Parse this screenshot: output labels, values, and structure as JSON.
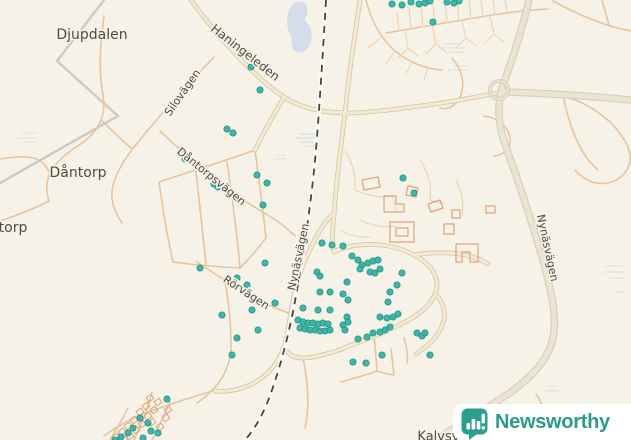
{
  "logo": {
    "name": "Newsworthy"
  },
  "map": {
    "bg": "#f7f2e8",
    "dot_color": "#38b2a2",
    "layers": [
      {
        "type": "line",
        "name": "boundary-path",
        "d": "M104,0 L57,61 L118,116 L0,183",
        "stroke": "#cbcbc4",
        "w": 2.5
      },
      {
        "type": "shape",
        "name": "water-area",
        "d": "M291,6 C294,1 301,0 306,4 C309,9 307,15 305,20 C310,25 313,33 311,41 C309,49 303,54 296,52 C291,50 292,42 291,36 C287,30 286,20 288,13 C289,9 290,8 291,6 Z",
        "fill": "#d4deea"
      },
      {
        "type": "marsh",
        "name": "marsh-texture",
        "groups": [
          {
            "color": "#d9e2ee",
            "lines": [
              [
                300,
                134,
                14
              ],
              [
                296,
                138,
                20
              ],
              [
                302,
                142,
                16
              ],
              [
                306,
                146,
                10
              ]
            ]
          },
          {
            "color": "#e4e4de",
            "lines": [
              [
                445,
                44,
                16
              ],
              [
                440,
                48,
                24
              ],
              [
                450,
                52,
                14
              ],
              [
                455,
                66,
                12
              ],
              [
                448,
                70,
                18
              ]
            ]
          },
          {
            "color": "#e4e4de",
            "lines": [
              [
                608,
                266,
                14
              ],
              [
                604,
                272,
                20
              ],
              [
                610,
                278,
                14
              ],
              [
                615,
                292,
                10
              ]
            ]
          },
          {
            "color": "#e4e4de",
            "lines": [
              [
                548,
                386,
                10
              ],
              [
                545,
                391,
                14
              ]
            ]
          },
          {
            "color": "#e6e6e0",
            "lines": [
              [
                22,
                133,
                14
              ],
              [
                18,
                138,
                18
              ],
              [
                25,
                142,
                10
              ]
            ]
          },
          {
            "color": "#e6e6e0",
            "lines": [
              [
                276,
                155,
                10
              ],
              [
                273,
                159,
                12
              ]
            ]
          }
        ]
      },
      {
        "type": "roads",
        "name": "minor-road",
        "stroke": "#e7c49e",
        "w": 1.6,
        "paths": [
          "M104,16 C100,45 99,70 102,88 C104,102 105,110 101,120 C96,133 86,141 76,147 C64,155 55,163 50,173 C46,182 46,192 49,201",
          "M49,201 C36,208 20,214 6,219 L0,221",
          "M0,159 C12,157 24,156 33,158 C42,160 46,166 50,173",
          "M101,120 C112,131 121,139 131,148",
          "M214,57 C188,84 158,117 135,146 C122,162 114,177 112,191 C111,204 116,214 122,223",
          "M160,131 C178,148 198,166 218,182 C236,196 256,208 274,219 C282,224 289,230 295,236",
          "M255,150 C222,162 189,172 159,182",
          "M159,182 C163,210 167,236 173,262",
          "M173,262 C196,265 219,267 240,268",
          "M255,150 C259,180 263,210 266,238",
          "M266,238 C257,250 248,260 240,268",
          "M196,171 L206,264",
          "M227,162 C232,196 237,232 240,268",
          "M197,262 C224,280 252,298 276,308 L293,315",
          "M225,281 C229,304 231,327 231,346 C231,360 226,374 217,385 C211,392 204,398 197,403",
          "M216,390 C196,396 176,402 160,408 C140,414 120,424 104,436",
          "M152,392 C148,408 142,424 134,440",
          "M170,402 C164,416 158,428 152,440",
          "M128,408 C122,420 116,430 110,440",
          "M374,334 L377,371 C366,375 352,379 341,382",
          "M391,349 L394,375 C388,374 382,373 377,371",
          "M404,338 C407,348 408,356 407,363",
          "M303,358 C308,382 310,406 305,428",
          "M563,96 C592,104 616,122 628,147 C633,160 629,172 618,179 C603,188 586,183 575,170",
          "M563,96 C570,128 580,155 598,170",
          "M553,1 C571,11 591,20 613,27 L631,31",
          "M602,0 L609,25",
          "M536,394 C543,404 546,414 544,424",
          "M386,33 C420,27 456,21 492,15 C512,12 530,10 548,9",
          "M366,0 C372,24 384,44 402,56 C414,64 428,69 442,70",
          "M452,58 C462,70 466,84 460,97 C456,106 448,110 440,108",
          "M484,116 C498,118 508,126 510,138 C511,148 504,155 494,156"
        ]
      },
      {
        "type": "roads",
        "name": "driveway",
        "stroke": "#eed7b8",
        "w": 1.3,
        "paths": [
          "M399,31 L397,12 M411,29 L409,8 M423,27 L421,6 M435,25 L433,4 M447,23 L445,2 M459,21 L457,0 M471,19 L469,0 M483,17 L481,0 M495,15 L493,0 M507,13 L505,0",
          "M405,31 L408,48 M408,48 L398,58 M408,48 L418,56 M432,25 L436,44 M436,44 L426,54 M436,44 L446,52 M462,21 L466,38 M466,38 L456,48 M466,38 L476,46 M490,16 L494,34 M494,34 L484,44 M494,34 L504,42",
          "M380,38 L368,48 M394,52 L386,64 M412,62 L406,74 M428,68 L424,80",
          "M345,150 C352,162 356,176 355,190 M355,190 C368,196 380,198 392,196 M392,196 L396,210",
          "M360,220 C372,226 384,228 396,226 M340,230 C350,236 360,238 370,237",
          "M420,160 C428,172 432,186 430,200 M430,200 L444,204",
          "M456,180 C462,192 464,204 462,216"
        ]
      },
      {
        "type": "roads2",
        "name": "secondary-road",
        "casing": "#d9c8a6",
        "cw": 4.8,
        "fill": "#f3ead6",
        "fw": 3.0,
        "paths": [
          "M191,0 C214,32 252,76 284,97 C306,111 330,113 352,113 C376,112 398,109 420,106 C448,103 476,97 503,92",
          "M284,97 C273,116 263,133 255,150",
          "M360,0 C355,35 350,65 347,95 C342,140 336,180 334,215 C332,233 332,243 334,252",
          "M334,252 C356,241 391,242 414,255 C433,265 441,280 435,294 C428,311 408,321 393,328 C372,338 353,344 342,349 C328,354 314,358 302,358 C295,358 291,356 288,352",
          "M333,214 C324,222 314,240 306,258 C298,276 293,298 290,318 C288,334 285,348 278,360 C270,373 258,382 245,387 C234,391 224,392 215,391",
          "M435,294 C444,302 447,314 442,326 C438,336 428,346 416,354",
          "M414,255 C432,252 450,252 466,255 C474,257 482,260 488,264"
        ]
      },
      {
        "type": "roads2",
        "name": "highway",
        "casing": "#d7ceba",
        "cw": 7.5,
        "fill": "#ebe4d2",
        "fw": 5.2,
        "paths": [
          "M529,0 C521,34 510,66 502,88 C497,106 498,126 506,147 C518,180 532,222 544,264 C552,294 557,317 553,338 C548,362 526,383 499,400 C474,416 452,429 436,440",
          "M502,92 C544,93 588,96 631,100"
        ]
      },
      {
        "type": "circle",
        "name": "interchange-loop",
        "cx": 499,
        "cy": 90,
        "r": 9,
        "casing": "#d7ceba",
        "cw": 4,
        "fill": "#ebe4d2",
        "fw": 2
      },
      {
        "type": "rail",
        "name": "railway",
        "d": "M326,0 C323,50 320,100 316,150 C312,195 305,245 297,290 C291,325 283,358 272,390 C264,414 254,430 245,440",
        "base": "#fbfaf6",
        "bw": 4.5,
        "dash": "#45453f",
        "dw": 1.8,
        "dashes": "7 6"
      },
      {
        "type": "roads",
        "name": "building-outline",
        "stroke": "#dfa07b",
        "w": 1.2,
        "paths": [
          "M362,180 l16,-3 l2,10 l-16,3 Z",
          "M384,196 l12,0 l0,8 l8,0 l0,8 l-20,0 Z",
          "M408,186 l10,2 l-2,9 l-10,-2 Z",
          "M390,222 l24,0 l0,20 l-24,0 Z M396,228 l12,0 l0,8 l-12,0 Z",
          "M428,204 l12,-4 l3,8 l-12,4 Z",
          "M444,224 l10,0 l0,10 l-10,0 Z",
          "M456,244 l22,0 l0,18 l-8,0 l0,-10 l-8,0 l0,10 l-6,0 Z",
          "M486,206 l9,0 l0,7 l-9,0 Z",
          "M452,210 l8,0 l0,8 l-8,0 Z"
        ]
      },
      {
        "type": "rects",
        "name": "allotment-hut",
        "stroke": "#dfa07b",
        "w": 1,
        "rw": 6,
        "rh": 5,
        "rot": -35,
        "pts": [
          [
            150,
            398
          ],
          [
            158,
            402
          ],
          [
            146,
            406
          ],
          [
            154,
            410
          ],
          [
            140,
            412
          ],
          [
            148,
            416
          ],
          [
            134,
            420
          ],
          [
            142,
            424
          ],
          [
            128,
            426
          ],
          [
            136,
            430
          ],
          [
            122,
            432
          ],
          [
            130,
            436
          ],
          [
            116,
            437
          ],
          [
            124,
            440
          ],
          [
            152,
            422
          ],
          [
            160,
            427
          ],
          [
            166,
            418
          ],
          [
            168,
            410
          ]
        ]
      },
      {
        "type": "dots",
        "name": "poi-dot",
        "fill": "#38b2a2",
        "stroke": "#1f9488",
        "r": 3.1,
        "pts": [
          [
            392,
            4
          ],
          [
            402,
            5
          ],
          [
            411,
            2
          ],
          [
            419,
            4
          ],
          [
            425,
            3
          ],
          [
            430,
            1
          ],
          [
            447,
            2
          ],
          [
            454,
            3
          ],
          [
            459,
            1
          ],
          [
            433,
            22
          ],
          [
            251,
            67
          ],
          [
            260,
            90
          ],
          [
            227,
            129
          ],
          [
            233,
            133
          ],
          [
            185,
            159
          ],
          [
            257,
            175
          ],
          [
            267,
            183
          ],
          [
            214,
            184
          ],
          [
            218,
            187
          ],
          [
            263,
            205
          ],
          [
            403,
            178
          ],
          [
            414,
            193
          ],
          [
            200,
            268
          ],
          [
            265,
            263
          ],
          [
            237,
            278
          ],
          [
            247,
            285
          ],
          [
            275,
            303
          ],
          [
            252,
            310
          ],
          [
            222,
            315
          ],
          [
            258,
            330
          ],
          [
            237,
            338
          ],
          [
            232,
            355
          ],
          [
            322,
            243
          ],
          [
            332,
            245
          ],
          [
            343,
            246
          ],
          [
            352,
            256
          ],
          [
            358,
            260
          ],
          [
            362,
            265
          ],
          [
            368,
            263
          ],
          [
            373,
            261
          ],
          [
            378,
            260
          ],
          [
            360,
            269
          ],
          [
            370,
            272
          ],
          [
            375,
            273
          ],
          [
            380,
            269
          ],
          [
            317,
            272
          ],
          [
            320,
            276
          ],
          [
            402,
            273
          ],
          [
            397,
            285
          ],
          [
            347,
            282
          ],
          [
            320,
            292
          ],
          [
            330,
            292
          ],
          [
            343,
            294
          ],
          [
            390,
            292
          ],
          [
            388,
            302
          ],
          [
            348,
            300
          ],
          [
            303,
            308
          ],
          [
            318,
            310
          ],
          [
            330,
            310
          ],
          [
            347,
            317
          ],
          [
            348,
            322
          ],
          [
            380,
            317
          ],
          [
            387,
            318
          ],
          [
            393,
            317
          ],
          [
            398,
            314
          ],
          [
            298,
            320
          ],
          [
            303,
            322
          ],
          [
            308,
            323
          ],
          [
            313,
            323
          ],
          [
            318,
            324
          ],
          [
            323,
            323
          ],
          [
            328,
            324
          ],
          [
            300,
            328
          ],
          [
            305,
            329
          ],
          [
            310,
            330
          ],
          [
            315,
            330
          ],
          [
            320,
            331
          ],
          [
            325,
            331
          ],
          [
            330,
            330
          ],
          [
            343,
            325
          ],
          [
            345,
            330
          ],
          [
            385,
            330
          ],
          [
            390,
            327
          ],
          [
            367,
            337
          ],
          [
            358,
            339
          ],
          [
            373,
            333
          ],
          [
            380,
            332
          ],
          [
            417,
            333
          ],
          [
            422,
            336
          ],
          [
            425,
            333
          ],
          [
            430,
            355
          ],
          [
            382,
            355
          ],
          [
            353,
            362
          ],
          [
            366,
            363
          ],
          [
            167,
            399
          ],
          [
            140,
            418
          ],
          [
            148,
            423
          ],
          [
            133,
            428
          ],
          [
            151,
            431
          ],
          [
            158,
            433
          ],
          [
            143,
            438
          ],
          [
            121,
            437
          ],
          [
            115,
            440
          ],
          [
            128,
            433
          ]
        ]
      },
      {
        "type": "labels",
        "name": "place-label",
        "color": "#4c4c43",
        "halo": "#f7f2e8",
        "items": [
          {
            "t": "Djupdalen",
            "x": 92,
            "y": 35,
            "s": 14,
            "r": 0
          },
          {
            "t": "Dåntorp",
            "x": 78,
            "y": 173,
            "s": 14,
            "r": 0
          },
          {
            "t": "torp",
            "x": 13,
            "y": 228,
            "s": 14,
            "r": 0
          },
          {
            "t": "Kalvsvik",
            "x": 444,
            "y": 437,
            "s": 13,
            "r": 0
          },
          {
            "t": "Haningeleden",
            "x": 245,
            "y": 53,
            "s": 12,
            "r": 38
          },
          {
            "t": "Silovägen",
            "x": 183,
            "y": 93,
            "s": 11,
            "r": -55
          },
          {
            "t": "Dåntorpsvägen",
            "x": 211,
            "y": 177,
            "s": 11,
            "r": 39
          },
          {
            "t": "Rörvägen",
            "x": 246,
            "y": 293,
            "s": 11,
            "r": 33
          },
          {
            "t": "Nynäsvägen",
            "x": 299,
            "y": 257,
            "s": 11,
            "r": -78
          },
          {
            "t": "Nynäsvägen",
            "x": 547,
            "y": 248,
            "s": 11,
            "r": 78
          }
        ]
      }
    ]
  }
}
